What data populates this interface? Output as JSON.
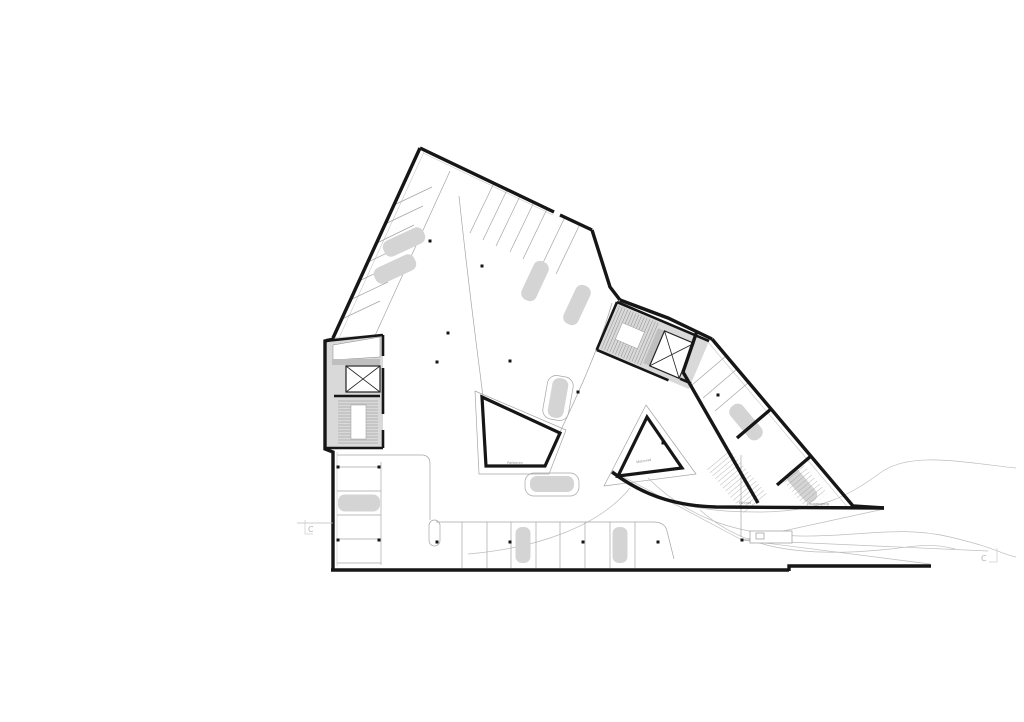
{
  "plan": {
    "labels": {
      "parkieren": "Parkieren",
      "motorrad": "Motorrad",
      "fahrrad": "Fahrrad",
      "hauseingang": "Hauseingang"
    },
    "section_label_left": "C",
    "section_label_right": "C",
    "colors": {
      "background": "#ffffff",
      "walls": "#161616",
      "core_fill": "#d9d9d9",
      "car_fill": "#d4d4d4",
      "thin_lines": "#a5a5a5"
    }
  }
}
